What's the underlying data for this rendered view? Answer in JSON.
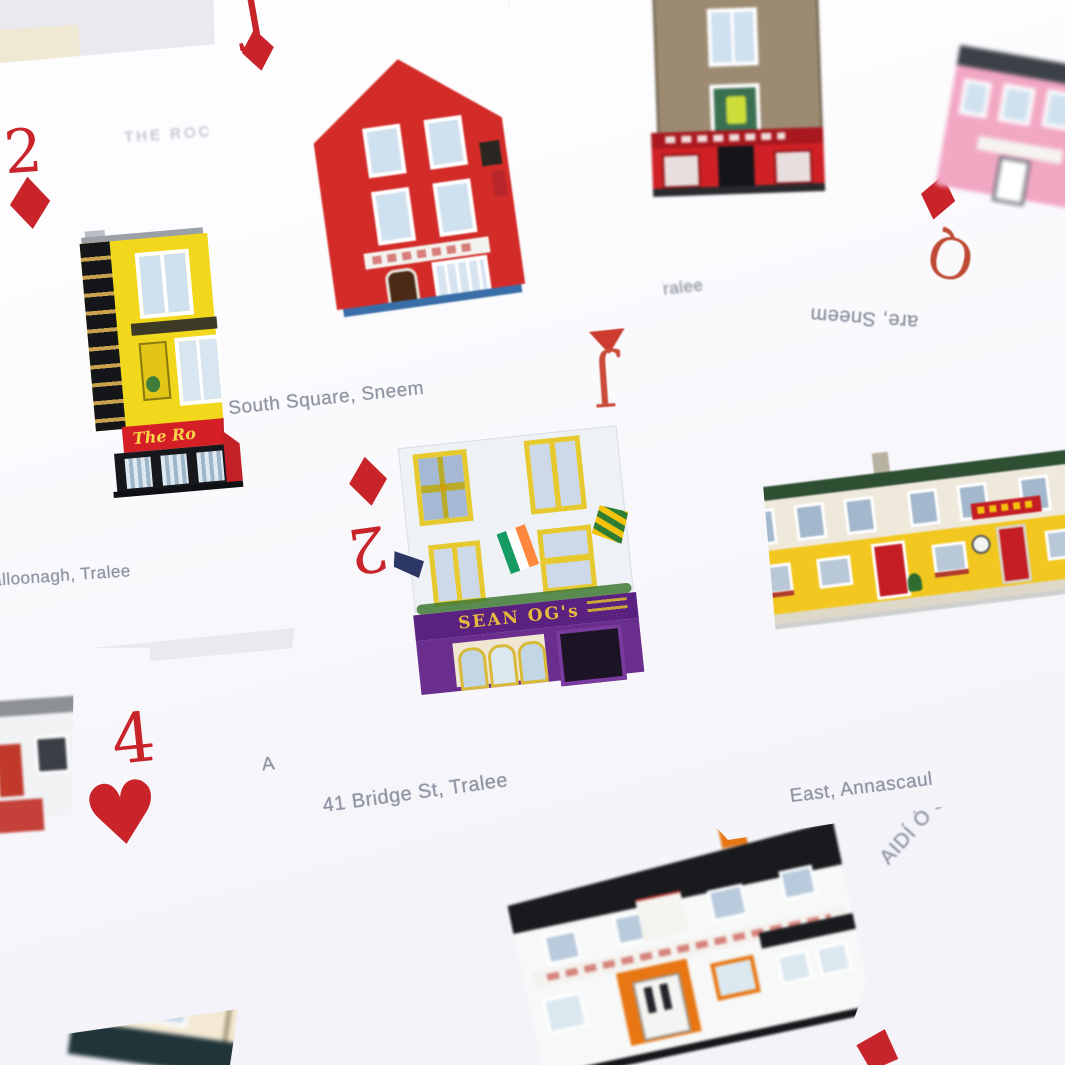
{
  "colors": {
    "suit_red": "#c8242a",
    "suit_black": "#1c1c22",
    "caption_gray": "#8d93a0",
    "title_gray": "#c3c8d2",
    "card_white": "#fdfdff"
  },
  "cards": [
    {
      "id": "rock-pub",
      "rank": "2",
      "suit_glyph": "♦",
      "title": "THE ROC",
      "caption": "alloonagh, Tralee",
      "building_sign": "The Ro"
    },
    {
      "id": "south-square",
      "rank": "J",
      "suit_glyph": "♦",
      "caption": "South Square, Sneem"
    },
    {
      "id": "the-mall",
      "caption": "The Mal, Tralee"
    },
    {
      "id": "queen-diamonds",
      "rank": "Q",
      "suit_glyph": "♦"
    },
    {
      "id": "sneem-inverted",
      "rank": "J",
      "caption": "are, Sneem"
    },
    {
      "id": "sean-ogs",
      "rank": "2",
      "suit_glyph": "♦",
      "caption": "41 Bridge St, Tralee",
      "building_sign": "SEAN OG's"
    },
    {
      "id": "inch-east",
      "rank": "3",
      "suit_glyph": "♣",
      "caption": "Inch East, Annascaul"
    },
    {
      "id": "four-hearts",
      "rank": "4",
      "suit_glyph": "♥",
      "caption": "A"
    },
    {
      "id": "paidi-o-se",
      "caption": "AIDÍ Ó S"
    }
  ]
}
